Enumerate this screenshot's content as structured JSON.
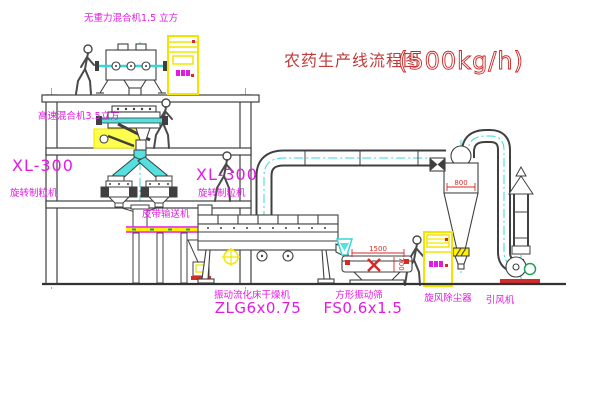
{
  "title": {
    "main": "农药生产线流程图",
    "capacity": "(500kg/h)"
  },
  "labels": {
    "gravity_mixer": "无重力混合机1.5 立方",
    "high_speed_mixer": "高速混合机3.5立方",
    "granulator_left": {
      "model": "XL-300",
      "name": "旋转制粒机"
    },
    "granulator_right": {
      "model": "XL-300",
      "name": "旋转制粒机"
    },
    "belt_conveyor": "皮带输送机",
    "dryer": {
      "name": "振动流化床干燥机",
      "model": "ZLG6x0.75"
    },
    "sieve": {
      "name": "方形振动筛",
      "model": "FS0.6x1.5"
    },
    "cyclone": "旋风除尘器",
    "fan": "引风机"
  },
  "dimensions": {
    "cyclone_width": "800",
    "sieve_length": "1500",
    "sieve_height": "700"
  },
  "colors": {
    "line": "#404040",
    "cyan": "#35d8d8",
    "magenta": "#e31ae3",
    "red": "#d42a2a",
    "yellow": "#f2e600",
    "green": "#1fa05a",
    "background": "#ffffff"
  }
}
